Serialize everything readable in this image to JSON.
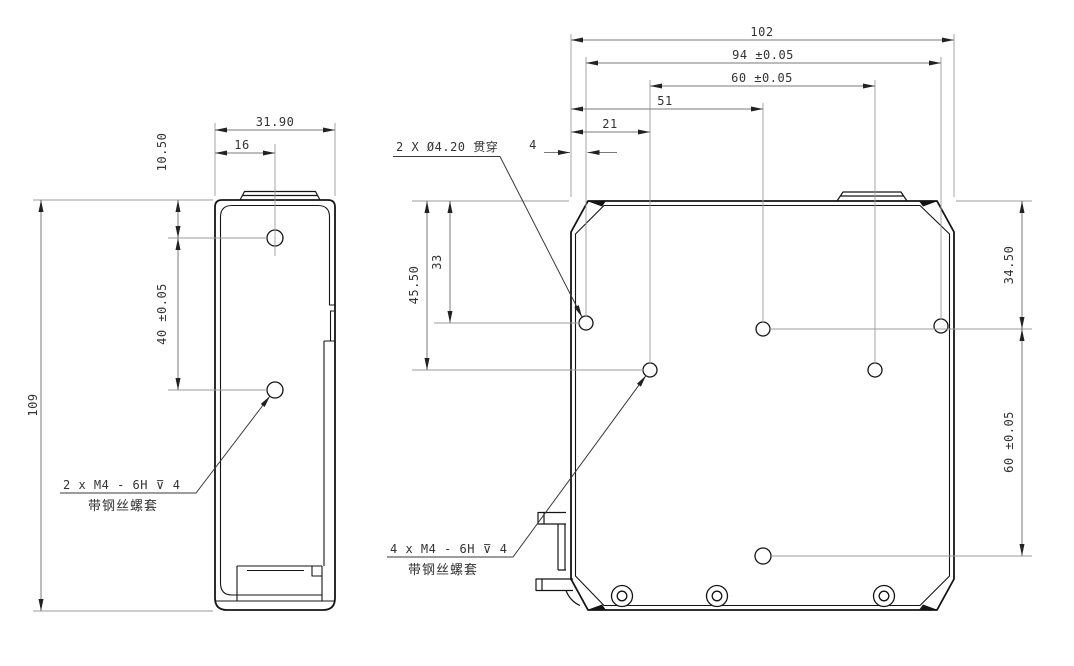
{
  "colors": {
    "background": "#ffffff",
    "outline": "#141414",
    "dimension_line": "#7a7a7a",
    "extension_line": "#9b9b9b",
    "text": "#333333"
  },
  "side_view": {
    "dim_width": "31.90",
    "dim_hole_offset_x": "16",
    "dim_hole_offset_top": "10.50",
    "dim_hole_pitch": "40 ±0.05",
    "dim_height": "109",
    "thread_callout": {
      "line1": "2 x M4 - 6H ⊽ 4",
      "line2": "带钢丝螺套"
    }
  },
  "front_view": {
    "dim_width": "102",
    "dim_mount_span": "94 ±0.05",
    "dim_thread_span": "60 ±0.05",
    "dim_51": "51",
    "dim_21": "21",
    "dim_4": "4",
    "dim_45_50": "45.50",
    "dim_33": "33",
    "dim_34_50": "34.50",
    "dim_60_right": "60 ±0.05",
    "hole_callout": "2 X Ø4.20 贯穿",
    "thread_callout": {
      "line1": "4 x M4 - 6H ⊽ 4",
      "line2": "带钢丝螺套"
    }
  }
}
